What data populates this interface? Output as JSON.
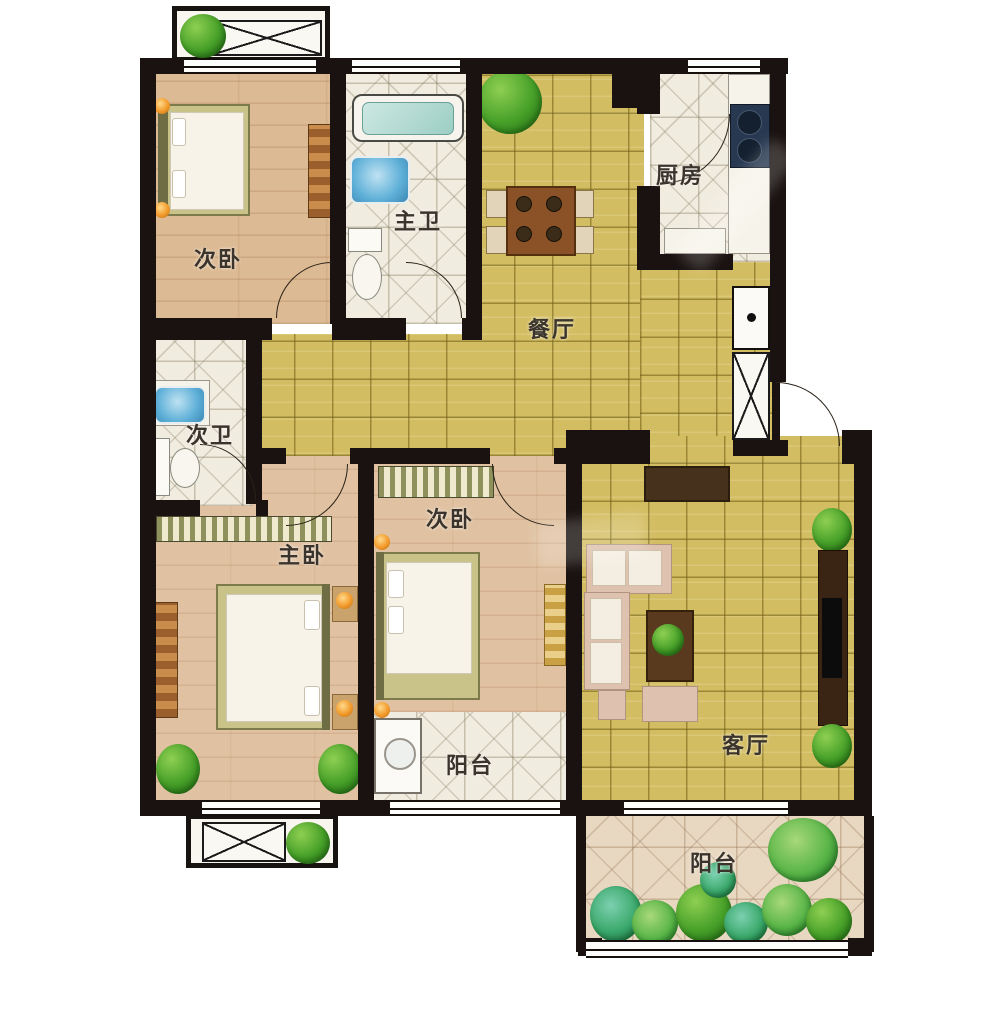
{
  "floor_plan": {
    "rooms": [
      {
        "id": "bedroom-north",
        "label": "次卧"
      },
      {
        "id": "master-bath",
        "label": "主卫"
      },
      {
        "id": "dining-room",
        "label": "餐厅"
      },
      {
        "id": "kitchen",
        "label": "厨房"
      },
      {
        "id": "second-bath",
        "label": "次卫"
      },
      {
        "id": "master-bedroom",
        "label": "主卧"
      },
      {
        "id": "bedroom-middle",
        "label": "次卧"
      },
      {
        "id": "balcony-inner",
        "label": "阳台"
      },
      {
        "id": "living-room",
        "label": "客厅"
      },
      {
        "id": "balcony-south",
        "label": "阳台"
      }
    ],
    "colors": {
      "wall": "#191210",
      "wood_floor": "#dcba94",
      "wood_floor_warm": "#e0c2a2",
      "tile_yellow": "#d3bd62",
      "tile_white": "#f1ece0",
      "tile_balcony": "#e9d8c1",
      "plant_green": "#46a028",
      "sink_blue": "#5fb0d8",
      "stove_navy": "#283850",
      "furniture_wood": "#8a5226",
      "sofa_beige": "#dec1ae",
      "lamp_orange": "#f29a2b",
      "entry_mat": "#46311d"
    }
  }
}
